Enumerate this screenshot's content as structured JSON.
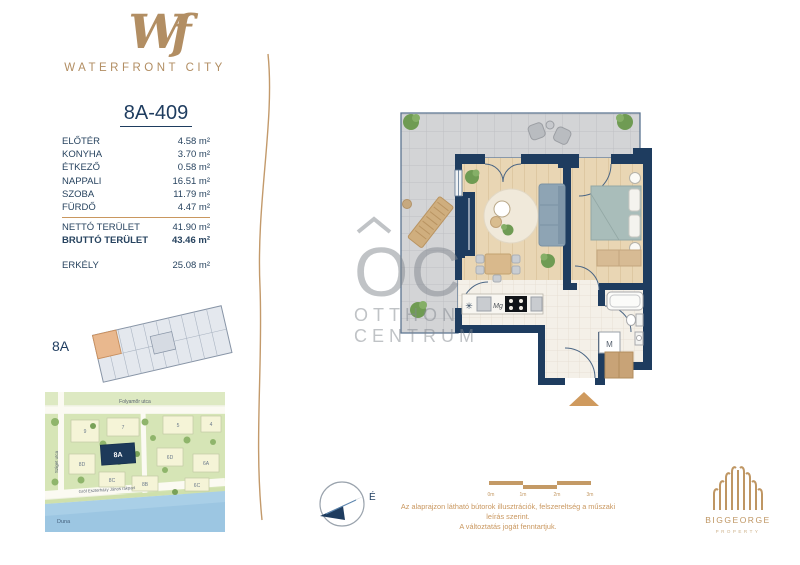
{
  "brand": {
    "monogram": "Wf",
    "name": "WATERFRONT CITY"
  },
  "unit": {
    "title": "8A-409",
    "rooms": [
      {
        "label": "ELŐTÉR",
        "area": "4.58 m²"
      },
      {
        "label": "KONYHA",
        "area": "3.70 m²"
      },
      {
        "label": "ÉTKEZŐ",
        "area": "0.58 m²"
      },
      {
        "label": "NAPPALI",
        "area": "16.51 m²"
      },
      {
        "label": "SZOBA",
        "area": "11.79 m²"
      },
      {
        "label": "FÜRDŐ",
        "area": "4.47 m²"
      }
    ],
    "totals": [
      {
        "label": "NETTÓ TERÜLET",
        "area": "41.90 m²"
      },
      {
        "label": "BRUTTÓ TERÜLET",
        "area": "43.46 m²"
      }
    ],
    "extra": {
      "label": "ERKÉLY",
      "area": "25.08 m²"
    }
  },
  "building": {
    "label": "8A"
  },
  "map": {
    "streets": {
      "top": "Folyamőr utca",
      "left": "Sziget utca",
      "quay": "Gróf Eszterházy János rakpart",
      "river": "Duna"
    },
    "highlight": "8A",
    "buildings": [
      "9",
      "7",
      "5",
      "4",
      "6D",
      "6A",
      "8D",
      "8C",
      "8B",
      "6C"
    ]
  },
  "floorplan": {
    "appliance_labels": {
      "fridge": "✳",
      "microwave": "Mg",
      "washing_machine": "M"
    },
    "watermark": {
      "initials": "OC",
      "line1": "OTTHON",
      "line2": "CENTRUM"
    }
  },
  "compass": {
    "north_label": "É"
  },
  "scalebar": {
    "ticks": [
      "0m",
      "1m",
      "2m",
      "3m"
    ]
  },
  "disclaimer": {
    "line1": "Az alaprajzon látható bútorok illusztrációk, felszereltség a műszaki leírás szerint.",
    "line2": "A változtatás jogát fenntartjuk."
  },
  "developer": {
    "name": "BIGGEORGE",
    "sub": "PROPERTY"
  },
  "colors": {
    "accent_tan": "#c49a66",
    "navy": "#1e3c5f",
    "highlight_orange": "#e9b88e",
    "river_blue": "#a9cfe7"
  }
}
